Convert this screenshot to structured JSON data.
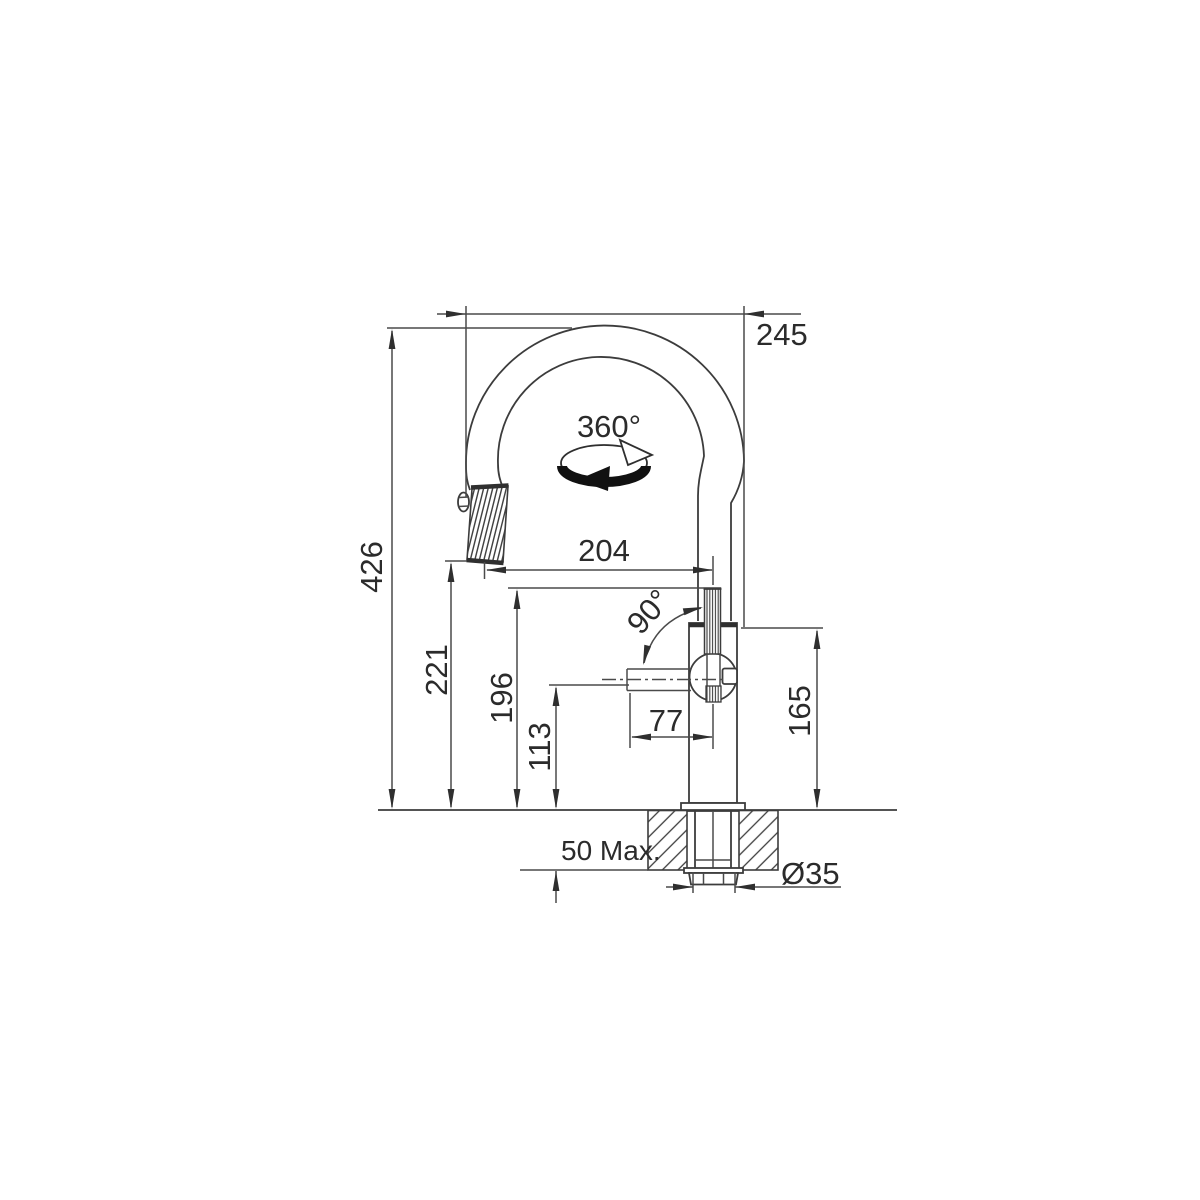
{
  "drawing": {
    "background_color": "#ffffff",
    "line_color": "#3c3c3c",
    "text_color": "#2b2b2b",
    "labels": {
      "total_height": "426",
      "spout_outlet_height": "221",
      "handle_top_height": "196",
      "lever_height": "113",
      "lever_reach": "77",
      "spout_reach": "204",
      "overall_projection": "245",
      "body_height": "165",
      "lever_swing_angle": "90°",
      "spout_swivel_angle": "360°",
      "max_deck_thickness": "50 Max.",
      "mounting_hole_diameter": "Ø35"
    }
  }
}
